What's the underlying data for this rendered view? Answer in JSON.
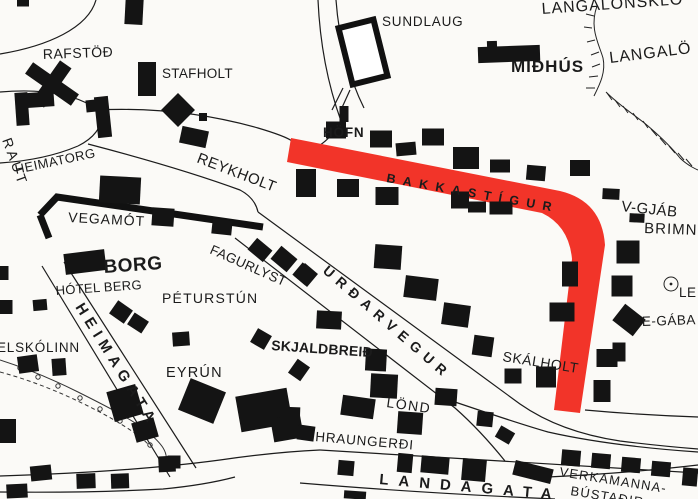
{
  "map": {
    "background": "#fbfaf7",
    "ink": "#1b1b1b",
    "highlight": {
      "color": "#f23429",
      "label_color": "#8e0f0f"
    },
    "labels": {
      "sundlaug": "SUNDLAUG",
      "langalonsklo": "LANGALÓNSKLÖ",
      "langalo": "LANGALÖ",
      "midhus": "MIÐHÚS",
      "rafstod": "RAFSTÖÐ",
      "stafholt": "STAFHOLT",
      "hofn": "HÖFN",
      "heimatorg": "HEIMATORG",
      "reykholt": "REYKHOLT",
      "raut": "RAUT",
      "vegamot": "VEGAMÓT",
      "borg": "BORG",
      "hotel_berg": "HÓTEL BERG",
      "fagurlyst": "FAGURLYST",
      "peturstun": "PÉTURSTÚN",
      "urdarvegur": "URÐARVEGUR",
      "skjaldbreid": "SKJALDBREIÐ",
      "skalholt": "SKÁLHOLT",
      "eyrun": "EYRÚN",
      "lond": "LÖND",
      "hraungerdi": "HRAUNGERÐI",
      "landagata": "LANDAGATA",
      "heimagata": "HEIMAGATA",
      "elskolinn": "ELSKÓLINN",
      "v_gjab": "V-GJÁB",
      "brimn": "BRIMN",
      "le": "LE",
      "e_gaba": "E-GÁBA",
      "verkamanna": "VERKAMANNA-",
      "bustadir": "BÚSTAÐIR",
      "bakkastigur": "BAKKASTÍGUR"
    }
  }
}
